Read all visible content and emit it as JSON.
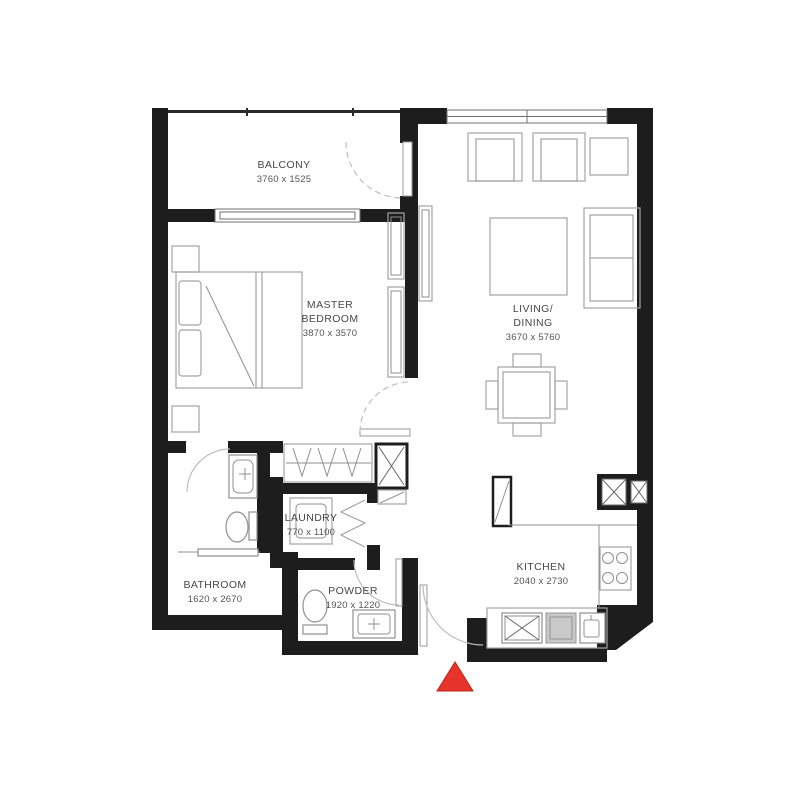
{
  "rooms": {
    "balcony": {
      "label": "BALCONY",
      "dims": "3760 x 1525"
    },
    "master_bedroom": {
      "label1": "MASTER",
      "label2": "BEDROOM",
      "dims": "3870 x 3570"
    },
    "living_dining": {
      "label1": "LIVING/",
      "label2": "DINING",
      "dims": "3670 x 5760"
    },
    "kitchen": {
      "label": "KITCHEN",
      "dims": "2040 x 2730"
    },
    "laundry": {
      "label": "LAUNDRY",
      "dims": "770 x 1100"
    },
    "bathroom": {
      "label": "BATHROOM",
      "dims": "1620 x 2670"
    },
    "powder": {
      "label": "POWDER",
      "dims": "1920 x 1220"
    }
  },
  "icons": {
    "entrance_marker": "red-triangle-entrance-arrow"
  },
  "colors": {
    "wall": "#1d1d1d",
    "furniture_line": "#a3a3a3",
    "entrance_red": "#e6342b",
    "entrance_red_edge": "#c02219"
  }
}
